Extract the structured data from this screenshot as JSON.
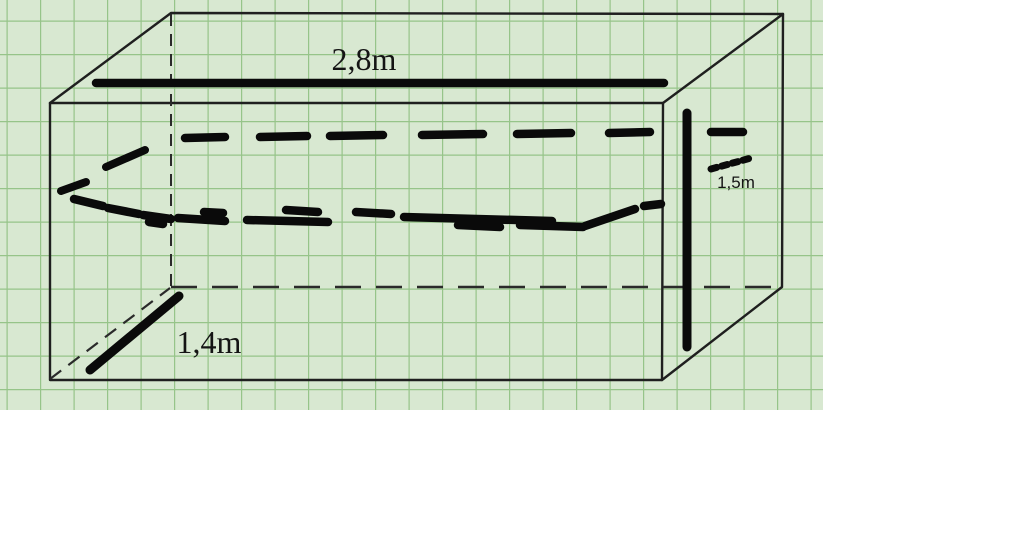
{
  "figure": {
    "dimensions": {
      "width_label": "2,8m",
      "height_label": "1,5m",
      "depth_label": "1,4m"
    }
  },
  "colors": {
    "page_background": "#ffffff",
    "paper": "#d8e8d1",
    "grid_line": "#96c489",
    "edge_ink": "#1f1f1f",
    "hidden_edge_ink": "#2a2a2a",
    "marker_ink": "#0a0a0a",
    "label_ink": "#141414"
  }
}
